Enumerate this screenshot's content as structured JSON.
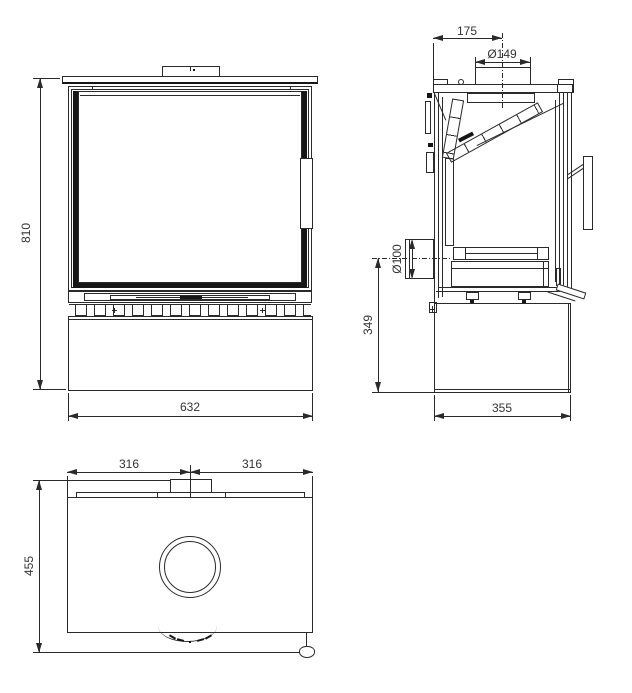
{
  "dims": {
    "front_height": "810",
    "front_width": "632",
    "flue_center_from_rear": "175",
    "flue_diameter": "Ø149",
    "air_inlet_diameter": "Ø100",
    "air_inlet_center_height": "349",
    "depth": "355",
    "top_half_width_left": "316",
    "top_half_width_right": "316",
    "top_overall_depth": "455"
  },
  "colors": {
    "line": "#2a2a2a",
    "dark_fill": "#161616",
    "background": "#ffffff"
  }
}
